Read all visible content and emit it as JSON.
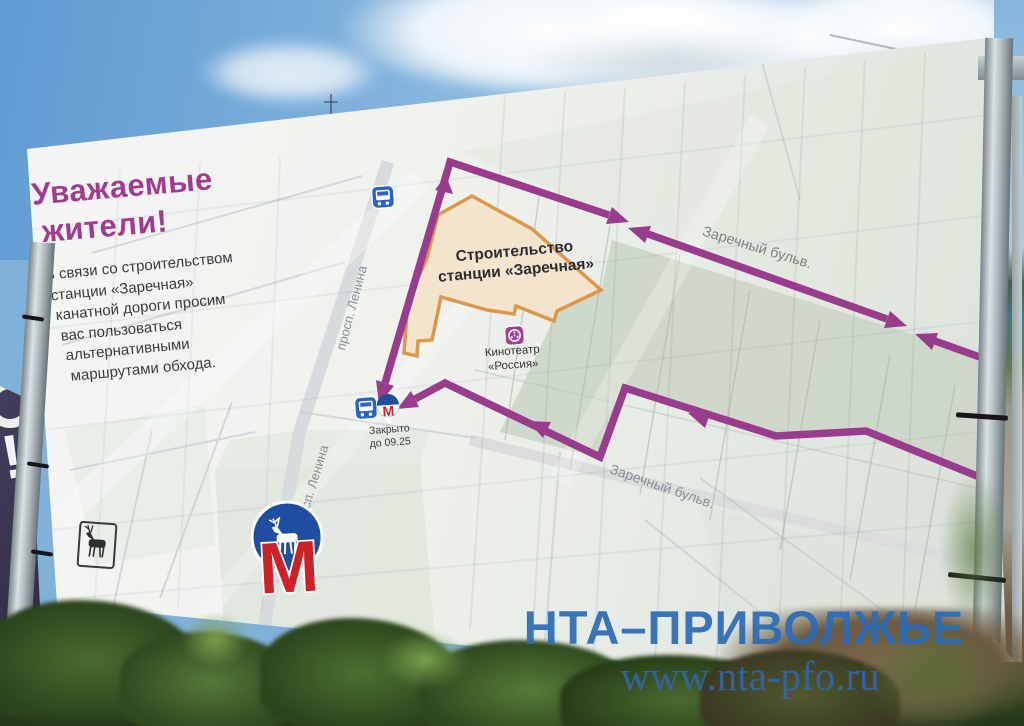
{
  "banner": {
    "title": [
      "Уважаемые",
      "жители!"
    ],
    "body": [
      "В связи со строительством",
      "станции «Заречная»",
      "канатной дороги просим",
      "вас пользоваться",
      "альтернативными",
      "маршрутами обхода."
    ]
  },
  "map": {
    "construction_label": [
      "Строительство",
      "станции «Заречная»"
    ],
    "cinema_label": [
      "Кинотеатр",
      "«Россия»"
    ],
    "metro_closed_label": [
      "Закрыто",
      "до 09.25"
    ],
    "streets": {
      "lenina_upper": "просп. Ленина",
      "lenina_lower": "просп. Ленина",
      "zarechny_upper": "Заречный бульв.",
      "zarechny_lower": "Заречный бульв."
    },
    "metro_letter": "М",
    "icons": [
      "bus-stop-icon",
      "metro-station-icon",
      "cinema-icon",
      "nizhny-novgorod-metro-logo",
      "city-coat-of-arms"
    ],
    "colors": {
      "route_purple": "#9a3c8e",
      "construction_outline": "#dc9441",
      "construction_fill": "#f4e4cd",
      "bus_blue": "#2a63c8",
      "cinema_magenta": "#a83b95",
      "metro_red": "#ce2127",
      "metro_blue": "#1e4da1",
      "title_magenta": "#a23a92"
    }
  },
  "side_banner": {
    "text": "!"
  },
  "watermark": {
    "agency": "НТА–ПРИВОЛЖЬЕ",
    "url": "www.nta-pfo.ru",
    "color": "#2b6cb8"
  }
}
